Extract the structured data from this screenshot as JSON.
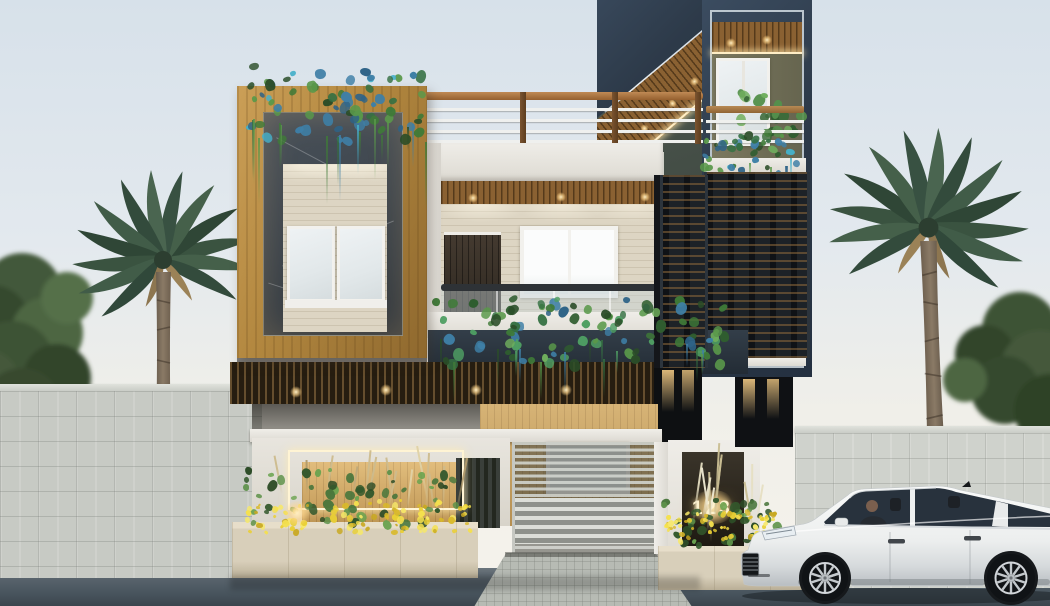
{
  "scene": {
    "type": "architectural-exterior-render",
    "description": "Modern two-storey house street elevation with compound wall, palm trees and parked white sedan",
    "daylight": "day"
  },
  "entrance": {
    "house_number": "123"
  },
  "vehicle": {
    "type": "white-luxury-sedan",
    "facing": "left",
    "occupant": "driver-visible"
  },
  "colors": {
    "sky_top": "#d7e1ea",
    "sky_horizon": "#f6f3ec",
    "navy_facade": "#2d3a49",
    "navy_trim_line": "#e2eaf0",
    "wood_frame": "#b2873f",
    "wood_soffit": "#8a6132",
    "travertine": "#ddd5c3",
    "marble_dark": "#3c444c",
    "marble_black": "#121417",
    "white_trim": "#ece9e4",
    "compound_wall": "#c7cac4",
    "road": "#4b565f",
    "gate": "#c0c3bd",
    "planter": "#d8cfba",
    "car_body": "#f1f2f2",
    "warm_led": "#ffeec6",
    "flower_yellow": "#e9cf35",
    "teal_accent": "#3e7fa6"
  },
  "palettes": {
    "hang_green": [
      "#2f5d2f",
      "#3f7a38",
      "#59984a",
      "#2a4d28",
      "#6fae5d",
      "#3e7fa6",
      "#2e6387",
      "#4f9f63",
      "#347042"
    ],
    "hang_teal": [
      "#3e7fa6",
      "#2e6387",
      "#3f7a38",
      "#59984a",
      "#2a4d28",
      "#45b0c9",
      "#347042"
    ],
    "fern": [
      "#3c6b3a",
      "#55904c",
      "#6fae5d",
      "#2f5d2f"
    ],
    "shrub": [
      "#33582c",
      "#49763c",
      "#5d9149",
      "#2c4b26",
      "#6aa34f"
    ],
    "yellow": [
      "#e9cf35",
      "#f4e04e",
      "#d9b92a",
      "#f7e868",
      "#c9a922"
    ],
    "grass": [
      "#cdbb8d",
      "#bfa97a",
      "#e0d2a6",
      "#b09a6c"
    ],
    "grass_light": [
      "#d8cfae",
      "#e6dfc2",
      "#c9bd92",
      "#efe9d2"
    ]
  }
}
